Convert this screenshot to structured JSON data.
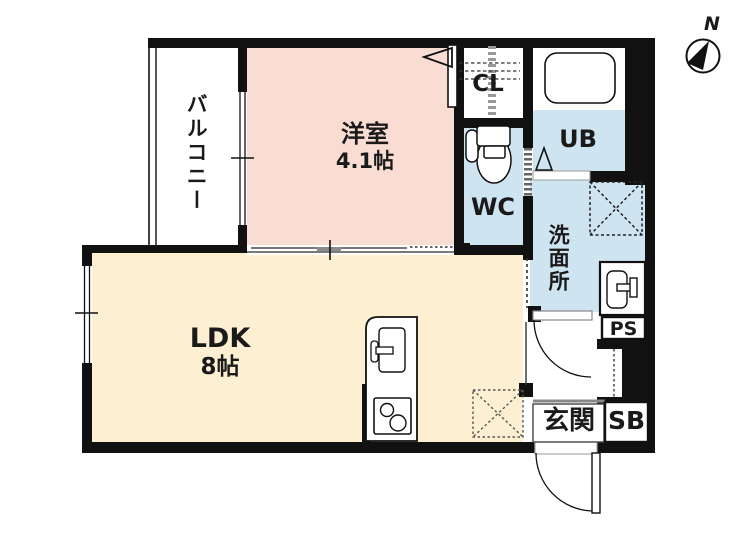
{
  "compass": {
    "north_label": "N"
  },
  "rooms": {
    "balcony": {
      "label": "バルコニー"
    },
    "bedroom": {
      "label": "洋室",
      "size": "4.1帖"
    },
    "closet": {
      "label": "CL"
    },
    "unit_bath": {
      "label": "UB"
    },
    "toilet": {
      "label": "WC"
    },
    "washroom": {
      "label": "洗面所"
    },
    "ldk": {
      "label": "LDK",
      "size": "8帖"
    },
    "pipe_space": {
      "label": "PS"
    },
    "entrance": {
      "label": "玄関"
    },
    "shoe_box": {
      "label": "SB"
    }
  },
  "colors": {
    "wall": "#111111",
    "bedroom_fill": "#f9dcd2",
    "ldk_fill": "#fdf0d2",
    "wet_area_fill": "#cfe4f1",
    "background": "#ffffff"
  }
}
